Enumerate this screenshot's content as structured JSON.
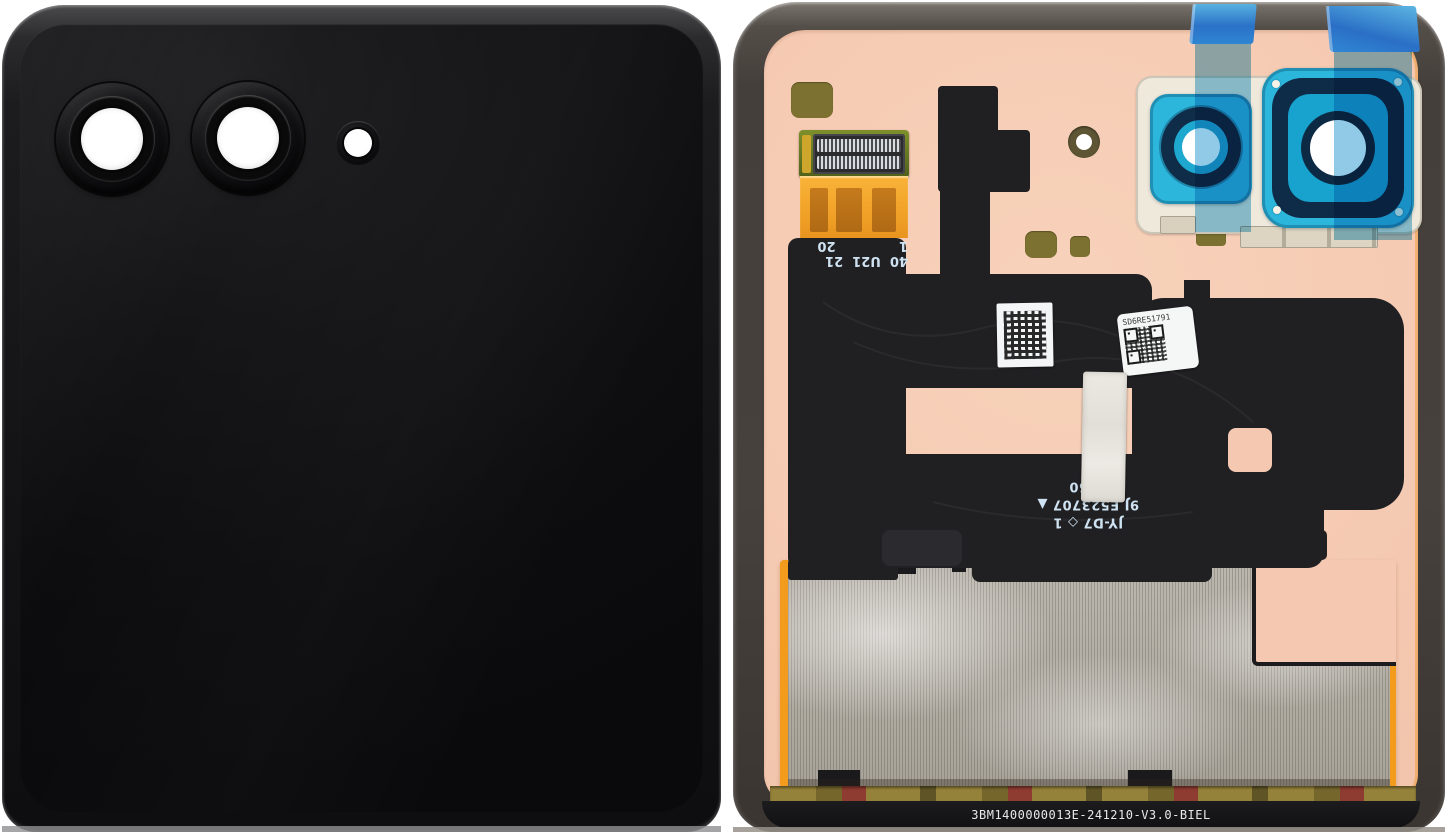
{
  "photo": {
    "subject": "Folding-phone cover display module: front glass panel (left) and rear flex assembly with pink backing (right)"
  },
  "front_panel": {
    "description": "Glossy black cover glass with dual camera lens rings and flash aperture"
  },
  "rear_panel": {
    "connector_label": {
      "line1": "40  U21  21",
      "line2": "1              20"
    },
    "flex_marking": {
      "line1": "JY-D7 ◇ 1",
      "line2": "9J E523707 ▲",
      "line3": "2450"
    },
    "serial_label": {
      "code": "SD6RE51791"
    },
    "part_number": "3BM1400000013E-241210-V3.0-BIEL"
  },
  "colors": {
    "backing_pink": "#f5c9b1",
    "frame_gray": "#453f3b",
    "flex_black": "#202023",
    "tape_blue": "#2eb1e0",
    "tape_tab_blue": "#2a6fc6",
    "camera_film_teal": "#2cb6dc",
    "camera_ring_navy": "#0e2b47",
    "flex_cable_orange": "#f2a329",
    "mesh_silver": "#b7b2a9",
    "accent_orange": "#f29b1c",
    "olive_pad": "#7c7130"
  }
}
